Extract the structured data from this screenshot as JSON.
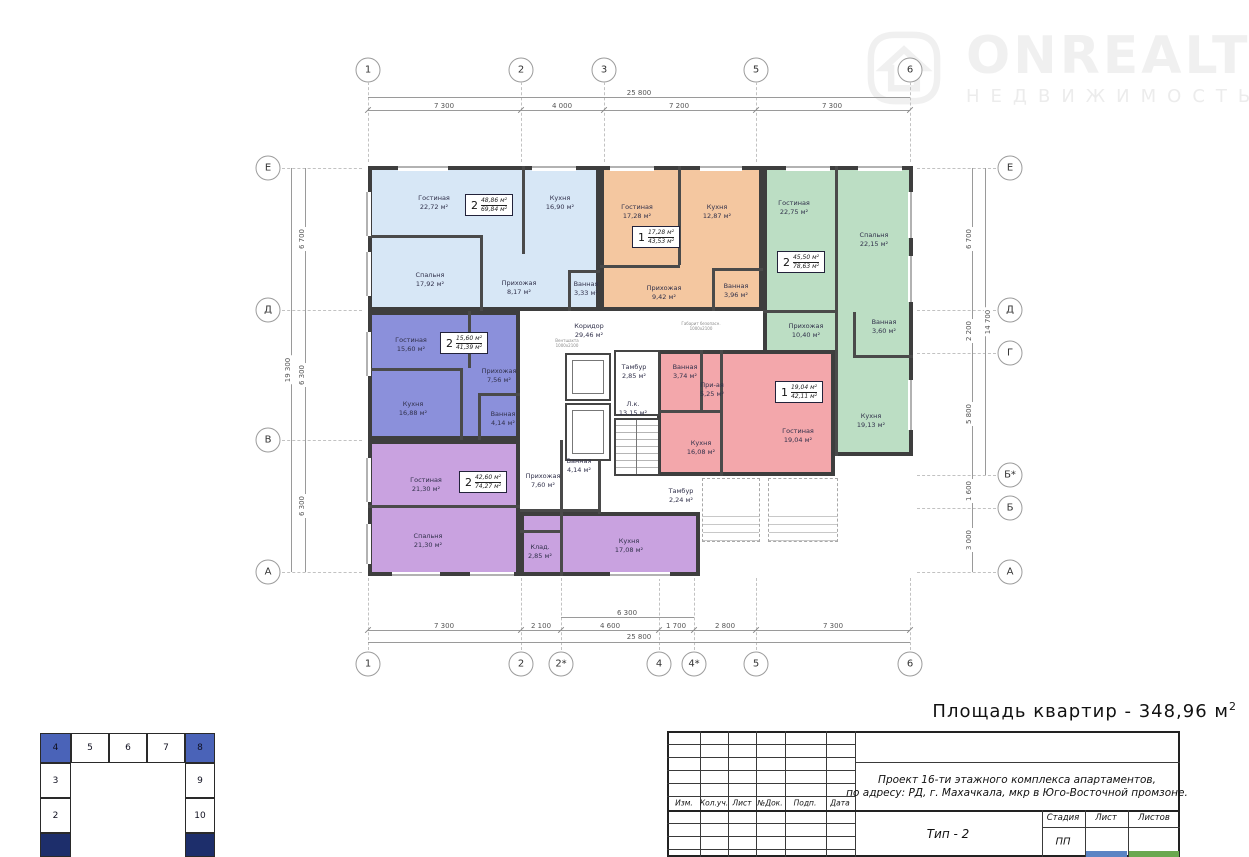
{
  "logo": {
    "brand": "ONREALT",
    "tagline": "НЕДВИЖИМОСТЬ"
  },
  "summary": {
    "text": "Площадь квартир - 348,96 м",
    "sup": "2"
  },
  "axes": {
    "top": [
      "1",
      "2",
      "3",
      "5",
      "6"
    ],
    "bottom": [
      "1",
      "2",
      "2*",
      "4",
      "4*",
      "5",
      "6"
    ],
    "left": [
      "Е",
      "Д",
      "В",
      "А"
    ],
    "right": [
      "Е",
      "Д",
      "Г",
      "Б*",
      "Б",
      "А"
    ]
  },
  "dims": {
    "top_total": "25 800",
    "top_segments": [
      "7 300",
      "4 000",
      "7 200",
      "7 300"
    ],
    "bottom_inner": "6 300",
    "bottom_segments": [
      "7 300",
      "2 100",
      "4 600",
      "1 700",
      "2 800",
      "7 300"
    ],
    "bottom_total": "25 800",
    "left_total": "19 300",
    "left_segments": [
      "6 700",
      "6 300",
      "6 300"
    ],
    "right_segments": [
      "6 700",
      "2 200",
      "5 800",
      "1 600",
      "3 000"
    ],
    "right_inner": "14 700"
  },
  "apartments": [
    {
      "color": "#d7e7f6",
      "badge": {
        "rooms": "2",
        "living": "48,86 м²",
        "total": "69,84 м²"
      },
      "rooms": [
        {
          "name": "Гостиная",
          "area": "22,72 м²"
        },
        {
          "name": "Кухня",
          "area": "16,90 м²"
        },
        {
          "name": "Спальня",
          "area": "17,92 м²"
        },
        {
          "name": "Прихожая",
          "area": "8,17 м²"
        },
        {
          "name": "Ванная",
          "area": "3,33 м²"
        }
      ]
    },
    {
      "color": "#f4c7a0",
      "badge": {
        "rooms": "1",
        "living": "17,28 м²",
        "total": "43,53 м²"
      },
      "rooms": [
        {
          "name": "Гостиная",
          "area": "17,28 м²"
        },
        {
          "name": "Кухня",
          "area": "12,87 м²"
        },
        {
          "name": "Прихожая",
          "area": "9,42 м²"
        },
        {
          "name": "Ванная",
          "area": "3,96 м²"
        }
      ]
    },
    {
      "color": "#bcdec4",
      "badge": {
        "rooms": "2",
        "living": "45,50 м²",
        "total": "78,63 м²"
      },
      "rooms": [
        {
          "name": "Гостиная",
          "area": "22,75 м²"
        },
        {
          "name": "Спальня",
          "area": "22,15 м²"
        },
        {
          "name": "Прихожая",
          "area": "10,40 м²"
        },
        {
          "name": "Ванная",
          "area": "3,60 м²"
        },
        {
          "name": "Кухня",
          "area": "19,13 м²"
        }
      ]
    },
    {
      "color": "#8b90db",
      "badge": {
        "rooms": "2",
        "living": "15,60 м²",
        "total": "41,39 м²"
      },
      "rooms": [
        {
          "name": "Гостиная",
          "area": "15,60 м²"
        },
        {
          "name": "Прихожая",
          "area": "7,56 м²"
        },
        {
          "name": "Кухня",
          "area": "16,88 м²"
        },
        {
          "name": "Ванная",
          "area": "4,14 м²"
        }
      ]
    },
    {
      "color": "#c9a2e0",
      "badge": {
        "rooms": "2",
        "living": "42,60 м²",
        "total": "74,27 м²"
      },
      "rooms": [
        {
          "name": "Гостиная",
          "area": "21,30 м²"
        },
        {
          "name": "Спальня",
          "area": "21,30 м²"
        },
        {
          "name": "Кухня",
          "area": "17,08 м²"
        },
        {
          "name": "Клад.",
          "area": "2,85 м²"
        },
        {
          "name": "Прихожая",
          "area": "7,60 м²"
        },
        {
          "name": "Ванная",
          "area": "4,14 м²"
        }
      ]
    },
    {
      "color": "#f3a7ab",
      "badge": {
        "rooms": "1",
        "living": "19,04 м²",
        "total": "42,11 м²"
      },
      "rooms": [
        {
          "name": "Гостиная",
          "area": "19,04 м²"
        },
        {
          "name": "Кухня",
          "area": "16,08 м²"
        },
        {
          "name": "При-ая",
          "area": "5,25 м²"
        },
        {
          "name": "Ванная",
          "area": "3,74 м²"
        }
      ]
    }
  ],
  "core": {
    "corridor": {
      "name": "Коридор",
      "area": "29,46 м²"
    },
    "stair": {
      "name": "Л.к.",
      "area": "13,15 м²"
    },
    "tambour1": {
      "name": "Тамбур",
      "area": "2,85 м²"
    },
    "tambour2": {
      "name": "Тамбур",
      "area": "2,24 м²"
    },
    "shaft_note": {
      "line1": "Вентшахта",
      "line2": "1000х2100"
    },
    "clearance_note": {
      "line1": "Габарит безопасн.",
      "line2": "1000х2100"
    }
  },
  "title_block": {
    "columns": [
      "Изм.",
      "Кол.уч.",
      "Лист",
      "№Док.",
      "Подп.",
      "Дата"
    ],
    "project_line1": "Проект 16-ти этажного комплекса апартаментов,",
    "project_line2": "по адресу: РД, г. Махачкала, мкр в Юго-Восточной промзоне.",
    "type_label": "Тип - 2",
    "stage_columns": [
      "Стадия",
      "Лист",
      "Листов"
    ],
    "stage_value": "ПП"
  },
  "key_plan": {
    "top_row": [
      "4",
      "5",
      "6",
      "7",
      "8"
    ],
    "left_col": [
      "3",
      "2"
    ],
    "right_col": [
      "9",
      "10"
    ],
    "highlight_color": "#4a63b8",
    "dark_color": "#1d2e6b"
  }
}
